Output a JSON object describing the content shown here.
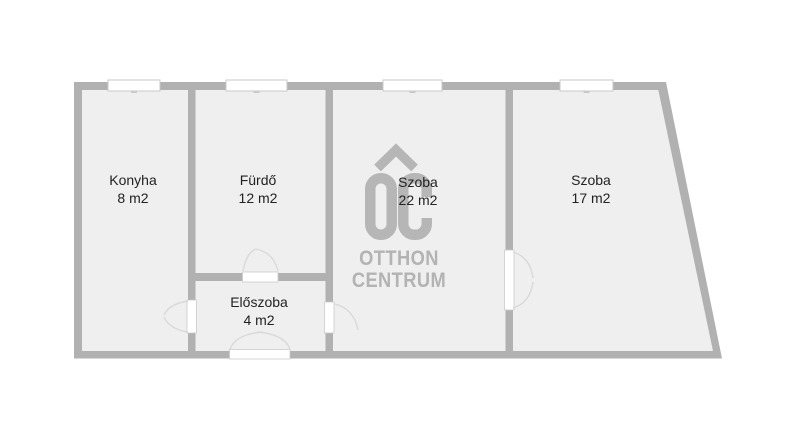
{
  "plan": {
    "colors": {
      "background": "#ffffff",
      "wall": "#b1b1b1",
      "room": "#efefef",
      "window": "#ffffff",
      "window_border": "#c9c9c9",
      "door_leaf": "#ffffff",
      "door_arc": "#d9d9d9",
      "text": "#222222",
      "logo": "#b6b6b6",
      "logo_text": "#b3b3b3"
    },
    "rooms": [
      {
        "name": "Konyha",
        "area": "8 m2"
      },
      {
        "name": "Fürdő",
        "area": "12 m2"
      },
      {
        "name": "Szoba",
        "area": "22 m2"
      },
      {
        "name": "Szoba",
        "area": "17 m2"
      },
      {
        "name": "Előszoba",
        "area": "4 m2"
      }
    ],
    "watermark": {
      "logo_icon": "otthon-centrum-house-logo-icon",
      "line1": "OTTHON",
      "line2": "CENTRUM"
    }
  }
}
